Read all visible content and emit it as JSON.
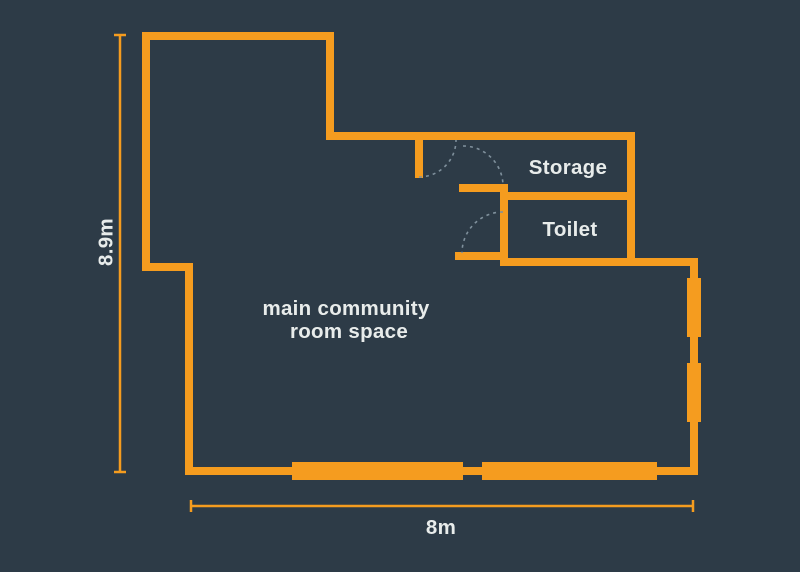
{
  "colors": {
    "background": "#2D3B47",
    "wall": "#F59C1F",
    "door_swing": "#7F909C",
    "text": "#E8ECEB"
  },
  "floor_plan": {
    "title": "community room floor plan",
    "rooms": [
      {
        "id": "main-room",
        "label_lines": [
          "main community",
          "room space"
        ]
      },
      {
        "id": "storage",
        "label": "Storage"
      },
      {
        "id": "toilet",
        "label": "Toilet"
      }
    ],
    "dimensions": [
      {
        "id": "height",
        "label": "8.9m",
        "orientation": "vertical"
      },
      {
        "id": "width",
        "label": "8m",
        "orientation": "horizontal"
      }
    ],
    "features": {
      "door_swings": 3,
      "window_segments": 4
    }
  }
}
